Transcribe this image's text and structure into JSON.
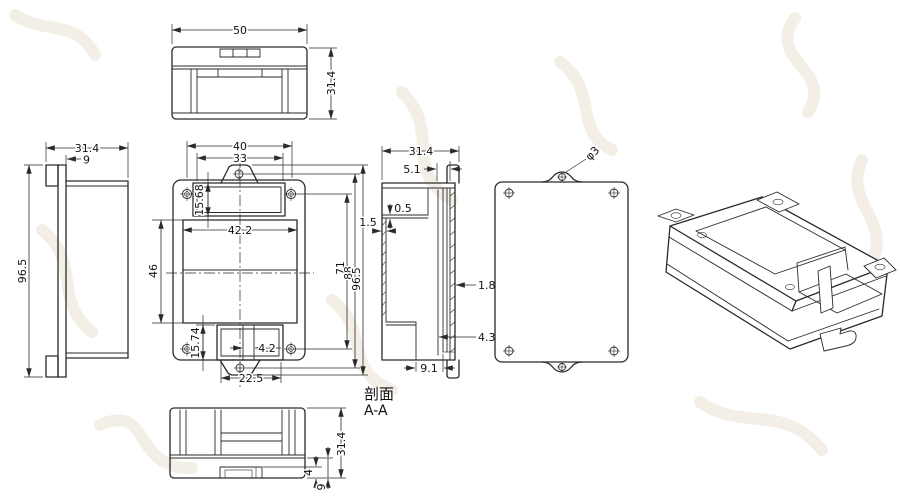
{
  "section_caption": {
    "line1": "剖面",
    "line2": "A-A"
  },
  "dims": {
    "top_w": "50",
    "top_h": "31.4",
    "left_w": "31.4",
    "left_ear": "9",
    "left_h": "96.5",
    "front_w40": "40",
    "front_w33": "33",
    "front_recess_h": "15.68",
    "front_inner_w": "42.2",
    "front_inner_h": "46",
    "front_brecess_h": "15.74",
    "front_slot": "4.2",
    "front_bottom_w": "22.5",
    "front_h71": "71",
    "front_h88": "88",
    "front_h965": "96.5",
    "sec_w": "31.4",
    "sec_51": "5.1",
    "sec_05": "0.5",
    "sec_15": "1.5",
    "sec_18": "1.8",
    "sec_43": "4.3",
    "sec_91": "9.1",
    "back_hole": "φ3",
    "bot_h": "31.4",
    "bot_4": "4",
    "bot_9": "9"
  }
}
